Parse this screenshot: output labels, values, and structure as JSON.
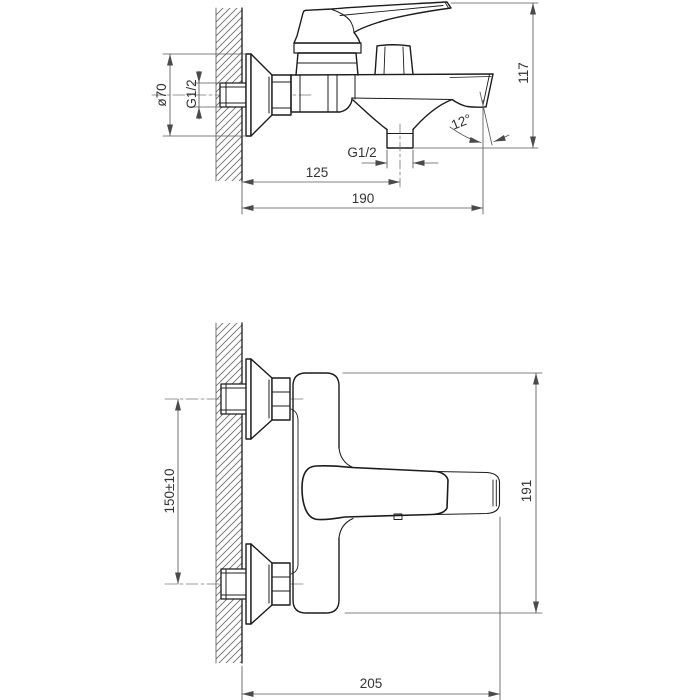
{
  "meta": {
    "background": "#ffffff",
    "line_color": "#1c1c1c",
    "dim_color": "#555555",
    "text_color": "#333333",
    "drawing_type": "technical drawing, wall-mounted bath mixer faucet, two orthographic views"
  },
  "side_view": {
    "labels": {
      "dia": "ø70",
      "wall_thread": "G1/2",
      "height": "117",
      "angle": "12°",
      "outlet_thread": "G1/2",
      "outlet_dist": "125",
      "projection": "190"
    }
  },
  "plan_view": {
    "labels": {
      "spacing": "150±10",
      "length": "191",
      "depth": "205"
    }
  }
}
